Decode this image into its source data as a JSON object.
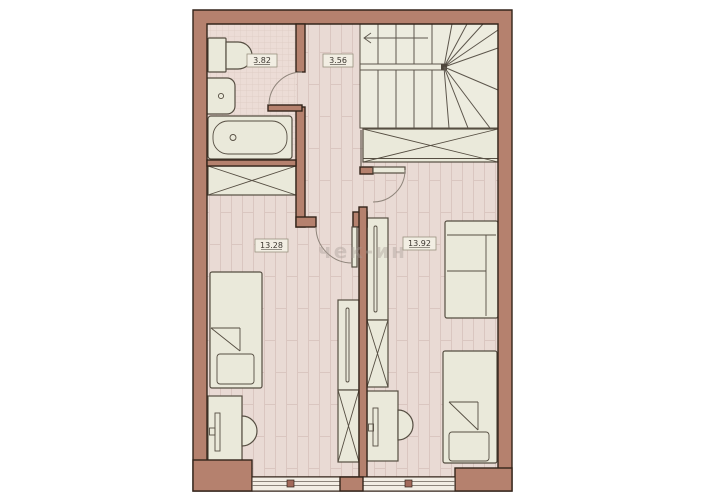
{
  "watermark": {
    "text": "чек-ин"
  },
  "rooms": [
    {
      "name": "bathroom",
      "area": "3.82"
    },
    {
      "name": "hallway",
      "area": "3.56"
    },
    {
      "name": "bedroom-left",
      "area": "13.28"
    },
    {
      "name": "bedroom-right",
      "area": "13.92"
    }
  ],
  "colors": {
    "background": "#ffffff",
    "wall_fill": "#b5816e",
    "wall_outline": "#33241a",
    "floor_fill": "#e9dad4",
    "floor_line": "#dac6c0",
    "tile_fill": "#ecdcd6",
    "tile_line": "#ddcac3",
    "furniture_fill": "#eae9da",
    "furniture_outline": "#564e42",
    "stair_fill": "#edecdf",
    "stair_line": "#5d564c",
    "window_fill": "#f2ede4",
    "window_line": "#6b6258",
    "label_text": "#3b362f",
    "watermark_color": "#a89d96"
  }
}
